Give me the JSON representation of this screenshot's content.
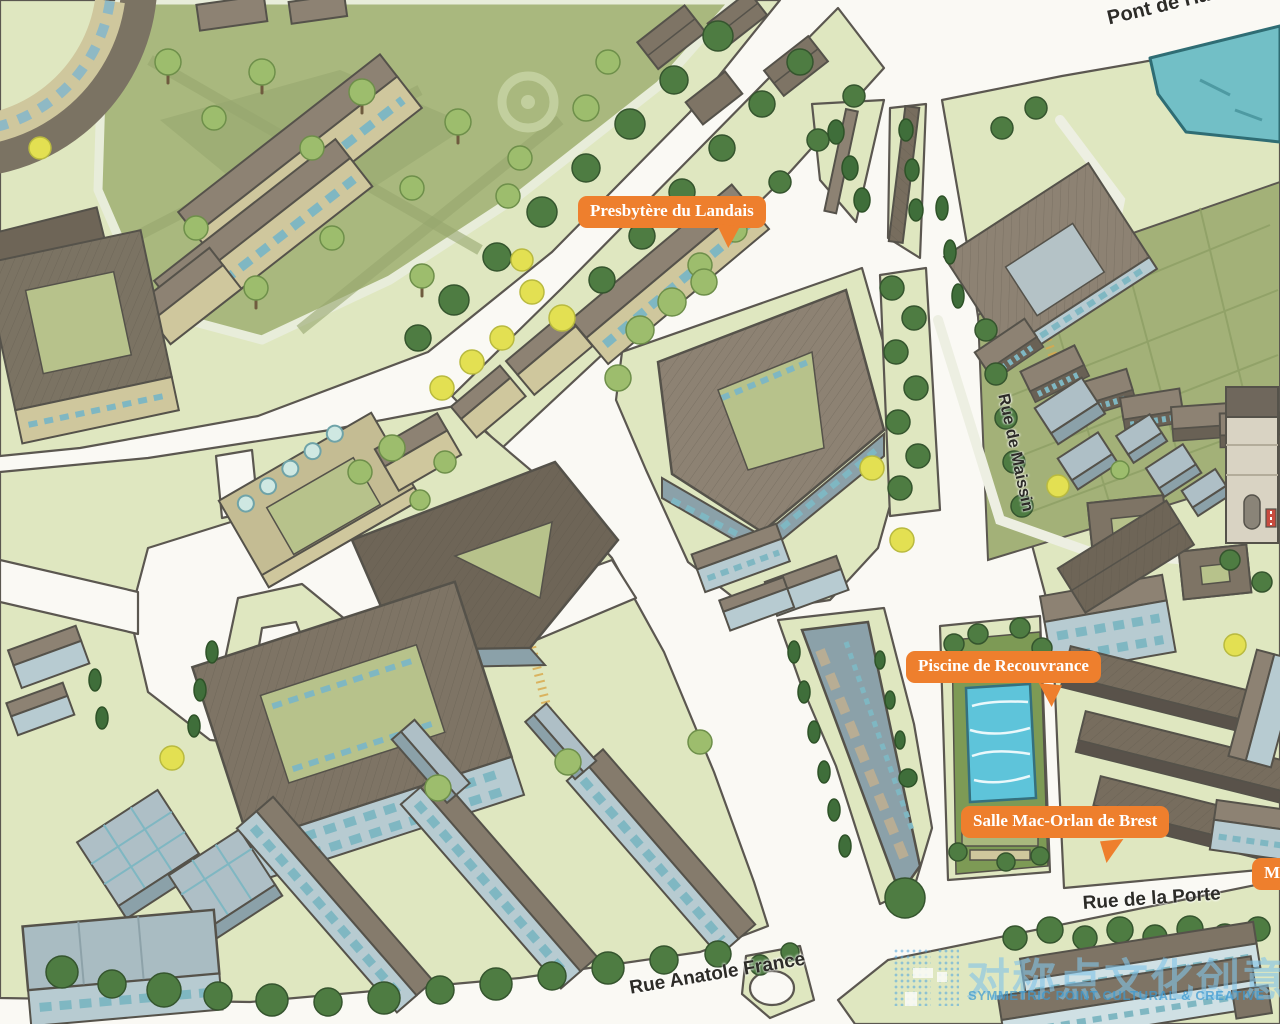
{
  "map": {
    "kind": "illustrated-isometric-city-map",
    "streets": [
      {
        "id": "pont-de-harteloire",
        "text": "Pont de Harteloire"
      },
      {
        "id": "rue-de-maissin",
        "text": "Rue de Maissin"
      },
      {
        "id": "rue-de-la-porte",
        "text": "Rue de la Porte"
      },
      {
        "id": "rue-anatole-france",
        "text": "Rue Anatole France"
      }
    ],
    "poi_labels": [
      {
        "id": "presbytere-du-landais",
        "text": "Presbytère du Landais"
      },
      {
        "id": "piscine-de-recouvrance",
        "text": "Piscine de Recouvrance"
      },
      {
        "id": "salle-mac-orlan-de-brest",
        "text": "Salle Mac-Orlan de Brest"
      },
      {
        "id": "musee-clipped",
        "text": "Mu"
      }
    ],
    "features": [
      "park-with-trees",
      "river-corner",
      "swimming-pool",
      "garden-allotments",
      "triangular-courtyard-building",
      "campus-building-rows",
      "roundabout"
    ],
    "colors": {
      "poi_label_bg": "#ee7f2d",
      "poi_label_text": "#ffffff",
      "street_text": "#2d2c28",
      "road": "#faf9f4",
      "block_green": "#dfe7c0",
      "park_olive": "#a9b87e",
      "garden": "#a3b178",
      "water": "#72bfc6",
      "pool": "#5ec4da",
      "tree_dark": "#4e7c42",
      "tree_light": "#9dbd6d",
      "tree_yellow": "#e3e052",
      "building_tan": "#cfc79d",
      "building_blue": "#b7cbd1",
      "roof_gray": "#8d8273",
      "roof_brown": "#7e7465",
      "watermark_blue": "#58aadd"
    }
  },
  "watermark": {
    "cjk": "对称点文化创意",
    "en": "SYMMETRIC POINT CULTURAL & CREATIVE"
  }
}
